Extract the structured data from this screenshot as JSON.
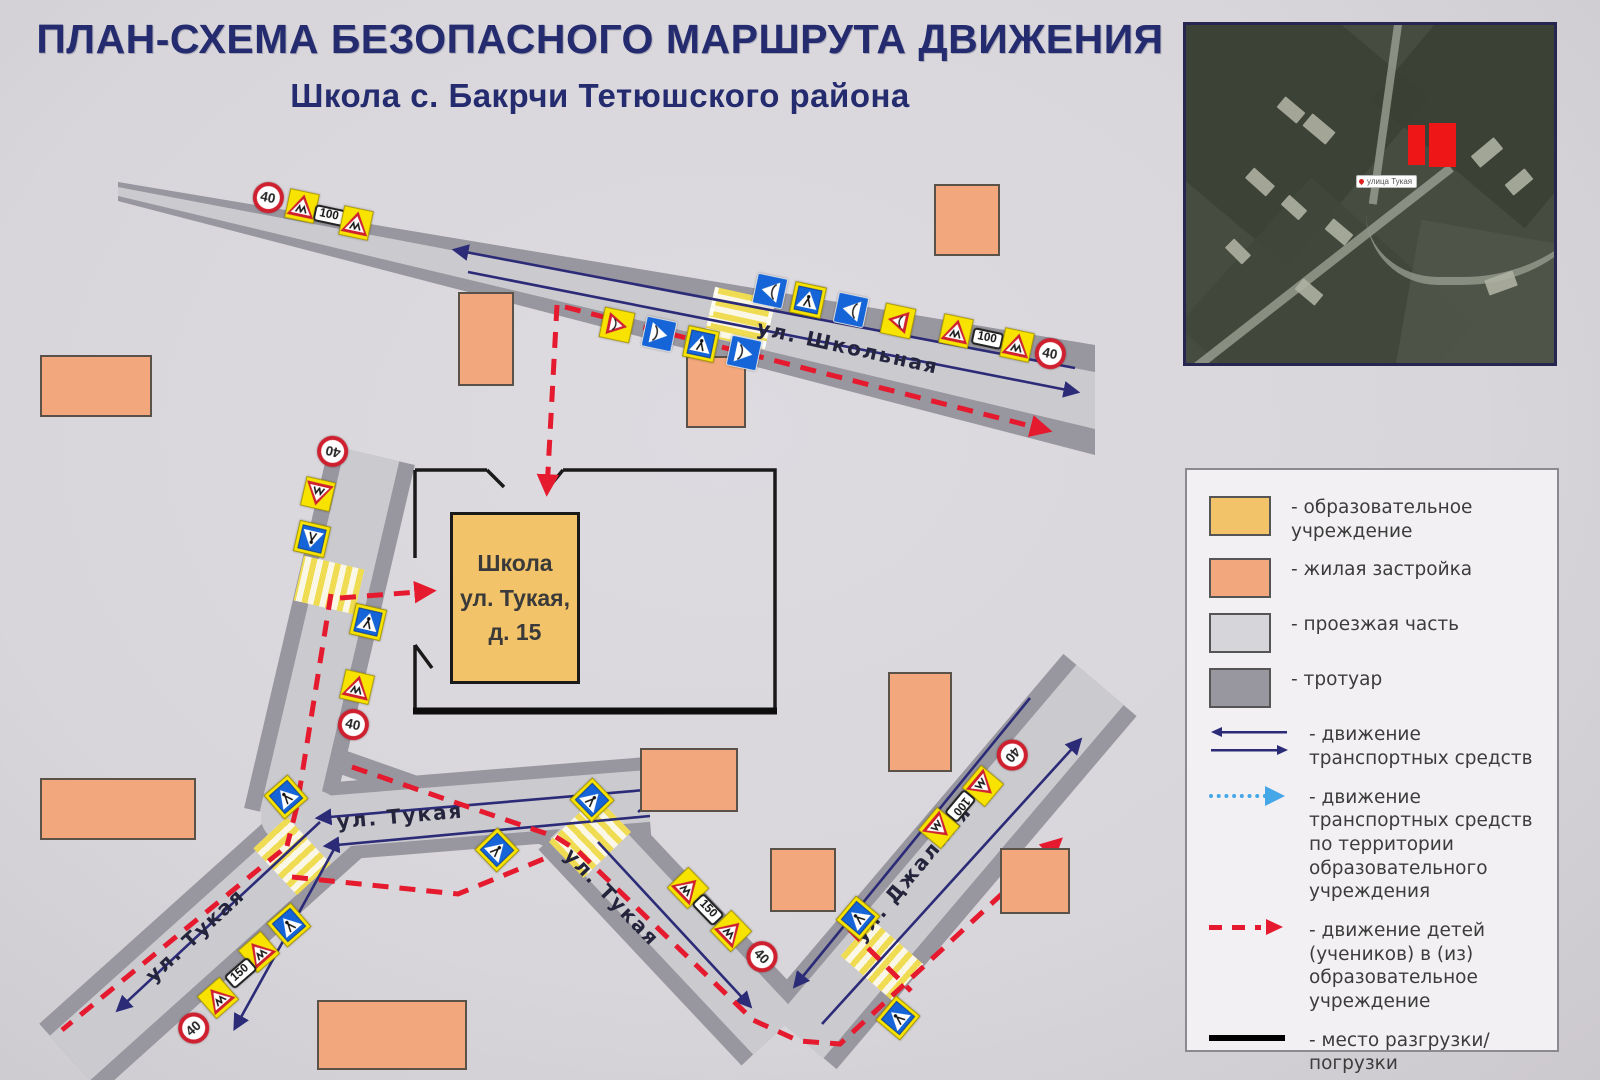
{
  "title": {
    "line1": "ПЛАН-СХЕМА БЕЗОПАСНОГО МАРШРУТА ДВИЖЕНИЯ",
    "line2": "Школа с. Бакрчи Тетюшского района"
  },
  "school": {
    "name": "Школа",
    "street": "ул. Тукая,",
    "house": "д. 15"
  },
  "streets": {
    "shkolnaya": "ул. Школьная",
    "tukaya": "ул. Тукая",
    "dzhalilya": "ул. Джалиля"
  },
  "signs": {
    "speed_limit": "40",
    "distance_100": "100",
    "distance_150": "150"
  },
  "inset": {
    "marker_label": "улица Тукая"
  },
  "legend": {
    "items": [
      {
        "id": "edu",
        "label": "- образовательное учреждение"
      },
      {
        "id": "res",
        "label": "- жилая застройка"
      },
      {
        "id": "road",
        "label": "- проезжая часть"
      },
      {
        "id": "side",
        "label": "- тротуар"
      },
      {
        "id": "traffic",
        "label": "- движение транспортных средств"
      },
      {
        "id": "campus",
        "label": "- движение транспортных средств по территории образовательного учреждения"
      },
      {
        "id": "children",
        "label": "- движение детей (учеников) в (из) образовательное учреждение"
      },
      {
        "id": "loading",
        "label": "- место разгрузки/погрузки"
      }
    ]
  },
  "colors": {
    "navy": "#242b6e",
    "paper": "#d8d6da",
    "road": "#cbcacf",
    "side": "#98969e",
    "school": "#f2c368",
    "res": "#f2a87c",
    "red": "#e51a2e",
    "blue": "#2b2b78",
    "ltblue": "#45a6e8",
    "signYellow": "#f8e300",
    "signBlue": "#1565d8",
    "signRed": "#cf2030"
  }
}
